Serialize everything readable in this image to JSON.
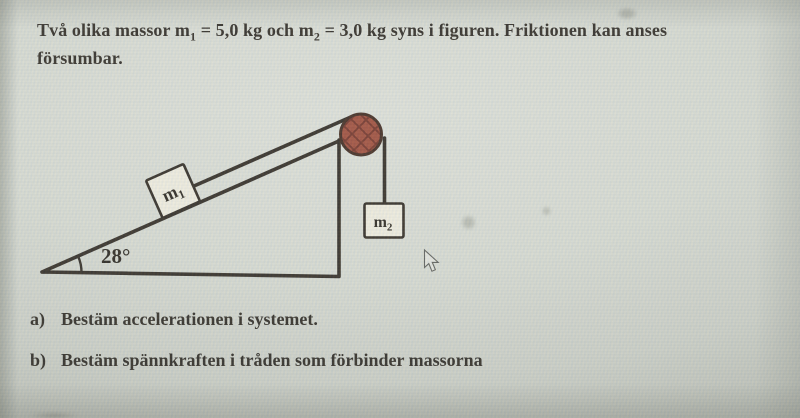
{
  "statement": {
    "line1_p1": "Två olika massor m",
    "line1_sub1": "1",
    "line1_p2": " = 5,0 kg och m",
    "line1_sub2": "2",
    "line1_p3": " = 3,0 kg syns i figuren. Friktionen kan anses",
    "line2": "försumbar."
  },
  "diagram": {
    "incline_angle_label": "28°",
    "mass1_label": {
      "base": "m",
      "sub": "1"
    },
    "mass2_label": {
      "base": "m",
      "sub": "2"
    },
    "colors": {
      "line": "#2c251e",
      "pulley_fill": "#9c4836",
      "pulley_hatch": "#6f2e23",
      "pulley_stroke": "#3c241a",
      "block_fill": "#edeadd"
    },
    "icons": {
      "pulley": "pulley-wheel",
      "cursor": "arrow-pointer"
    }
  },
  "questions": [
    {
      "label": "a)",
      "text": "Bestäm accelerationen i systemet."
    },
    {
      "label": "b)",
      "text": "Bestäm spännkraften i tråden som förbinder massorna"
    }
  ]
}
